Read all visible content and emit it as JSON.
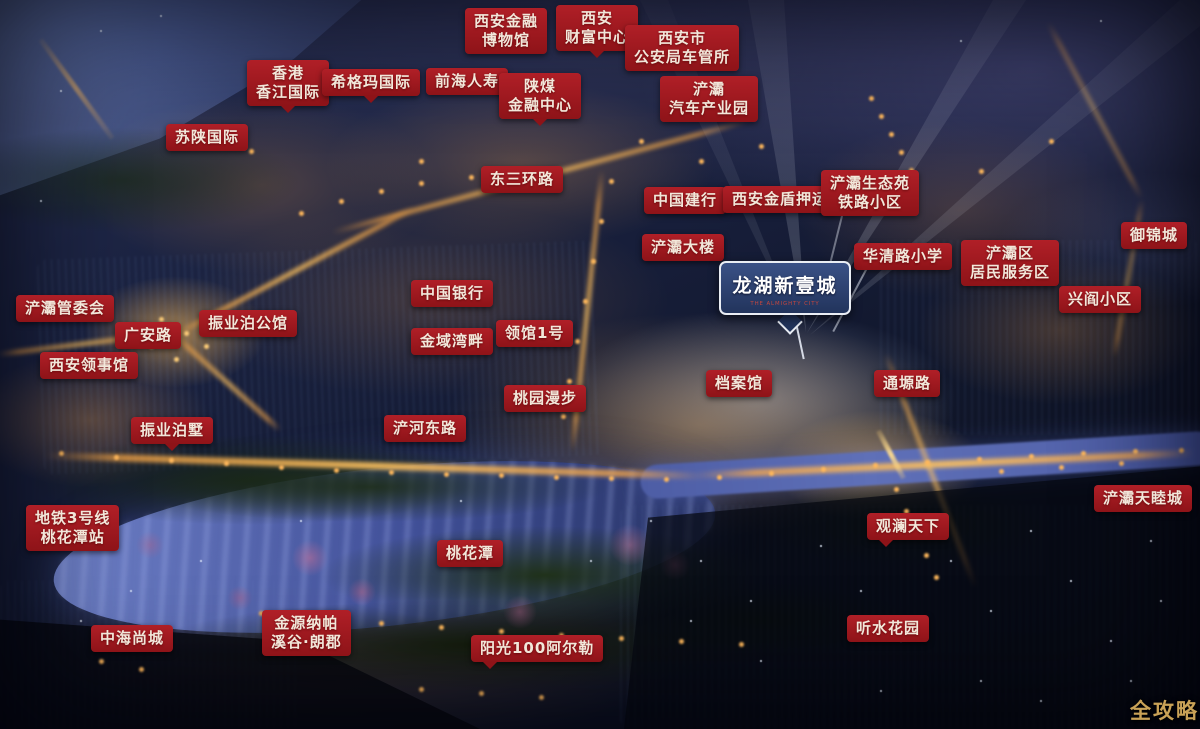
{
  "colors": {
    "label_red_top": "#b01f27",
    "label_red_bottom": "#8e1318",
    "label_text": "#f2e7da",
    "sign_blue_top": "#3a5186",
    "sign_blue_bottom": "#22345c",
    "sign_border": "#e9edf4",
    "sign_subtitle_red": "#c4463e",
    "watermark_gold": "#c9a257"
  },
  "project_sign": {
    "title": "龙湖新壹城",
    "subtitle": "THE ALMIGHTY CITY"
  },
  "watermark": "全攻略",
  "map_labels": [
    {
      "id": "xian-financial-museum",
      "lines": [
        "西安金融",
        "博物馆"
      ],
      "x": 465,
      "y": 8
    },
    {
      "id": "xian-wealth-center",
      "lines": [
        "西安",
        "财富中心"
      ],
      "x": 556,
      "y": 5,
      "tail": "b"
    },
    {
      "id": "psb-vehicle-office",
      "lines": [
        "西安市",
        "公安局车管所"
      ],
      "x": 625,
      "y": 25
    },
    {
      "id": "hk-xiangjiang-intl",
      "lines": [
        "香港",
        "香江国际"
      ],
      "x": 247,
      "y": 60,
      "tail": "b"
    },
    {
      "id": "sigma-intl",
      "lines": [
        "希格玛国际"
      ],
      "x": 322,
      "y": 69,
      "tail": "b"
    },
    {
      "id": "qianhai-life",
      "lines": [
        "前海人寿"
      ],
      "x": 426,
      "y": 68
    },
    {
      "id": "shaanmei-finance-center",
      "lines": [
        "陕煤",
        "金融中心"
      ],
      "x": 499,
      "y": 73,
      "tail": "b"
    },
    {
      "id": "chanba-auto-industry-park",
      "lines": [
        "浐灞",
        "汽车产业园"
      ],
      "x": 660,
      "y": 76
    },
    {
      "id": "sushaan-intl",
      "lines": [
        "苏陕国际"
      ],
      "x": 166,
      "y": 124
    },
    {
      "id": "east-3rd-ring-road",
      "lines": [
        "东三环路"
      ],
      "x": 481,
      "y": 166
    },
    {
      "id": "ccb-bank",
      "lines": [
        "中国建行"
      ],
      "x": 644,
      "y": 187
    },
    {
      "id": "xian-jindun-escort",
      "lines": [
        "西安金盾押运"
      ],
      "x": 723,
      "y": 186
    },
    {
      "id": "chanba-eco-garden-railway-community",
      "lines": [
        "浐灞生态苑",
        "铁路小区"
      ],
      "x": 821,
      "y": 170
    },
    {
      "id": "chanba-tower",
      "lines": [
        "浐灞大楼"
      ],
      "x": 642,
      "y": 234
    },
    {
      "id": "huaqing-road-primary-school",
      "lines": [
        "华清路小学"
      ],
      "x": 854,
      "y": 243
    },
    {
      "id": "chanba-resident-service-district",
      "lines": [
        "浐灞区",
        "居民服务区"
      ],
      "x": 961,
      "y": 240
    },
    {
      "id": "yujin-city",
      "lines": [
        "御锦城"
      ],
      "x": 1121,
      "y": 222
    },
    {
      "id": "xingyan-community",
      "lines": [
        "兴阎小区"
      ],
      "x": 1059,
      "y": 286
    },
    {
      "id": "chanba-admin-committee",
      "lines": [
        "浐灞管委会"
      ],
      "x": 16,
      "y": 295
    },
    {
      "id": "guangan-road",
      "lines": [
        "广安路"
      ],
      "x": 115,
      "y": 322
    },
    {
      "id": "zhenye-bo-mansion",
      "lines": [
        "振业泊公馆"
      ],
      "x": 199,
      "y": 310
    },
    {
      "id": "xian-consulate",
      "lines": [
        "西安领事馆"
      ],
      "x": 40,
      "y": 352
    },
    {
      "id": "bank-of-china",
      "lines": [
        "中国银行"
      ],
      "x": 411,
      "y": 280
    },
    {
      "id": "jinyu-bay",
      "lines": [
        "金域湾畔"
      ],
      "x": 411,
      "y": 328
    },
    {
      "id": "lingguan-no1",
      "lines": [
        "领馆1号"
      ],
      "x": 496,
      "y": 320
    },
    {
      "id": "taoyuan-stroll",
      "lines": [
        "桃园漫步"
      ],
      "x": 504,
      "y": 385
    },
    {
      "id": "chanhe-east-road",
      "lines": [
        "浐河东路"
      ],
      "x": 384,
      "y": 415
    },
    {
      "id": "zhenye-bo-villa",
      "lines": [
        "振业泊墅"
      ],
      "x": 131,
      "y": 417,
      "tail": "b"
    },
    {
      "id": "archives-hall",
      "lines": [
        "档案馆"
      ],
      "x": 706,
      "y": 370
    },
    {
      "id": "tongyuan-road",
      "lines": [
        "通塬路"
      ],
      "x": 874,
      "y": 370
    },
    {
      "id": "metro-line3-taohuatan-station",
      "lines": [
        "地铁3号线",
        "桃花潭站"
      ],
      "x": 26,
      "y": 505
    },
    {
      "id": "taohuatan-lake",
      "lines": [
        "桃花潭"
      ],
      "x": 437,
      "y": 540
    },
    {
      "id": "guanlan-tianxia",
      "lines": [
        "观澜天下"
      ],
      "x": 867,
      "y": 513,
      "tail": "bl"
    },
    {
      "id": "chanba-tianmucheng",
      "lines": [
        "浐灞天睦城"
      ],
      "x": 1094,
      "y": 485
    },
    {
      "id": "zhonghai-shangcheng",
      "lines": [
        "中海尚城"
      ],
      "x": 91,
      "y": 625
    },
    {
      "id": "jinyuan-napa-valley",
      "lines": [
        "金源纳帕",
        "溪谷·朗郡"
      ],
      "x": 262,
      "y": 610
    },
    {
      "id": "sunshine-100-arles",
      "lines": [
        "阳光100阿尔勒"
      ],
      "x": 471,
      "y": 635,
      "tail": "bl"
    },
    {
      "id": "tingshui-garden",
      "lines": [
        "听水花园"
      ],
      "x": 847,
      "y": 615
    }
  ]
}
